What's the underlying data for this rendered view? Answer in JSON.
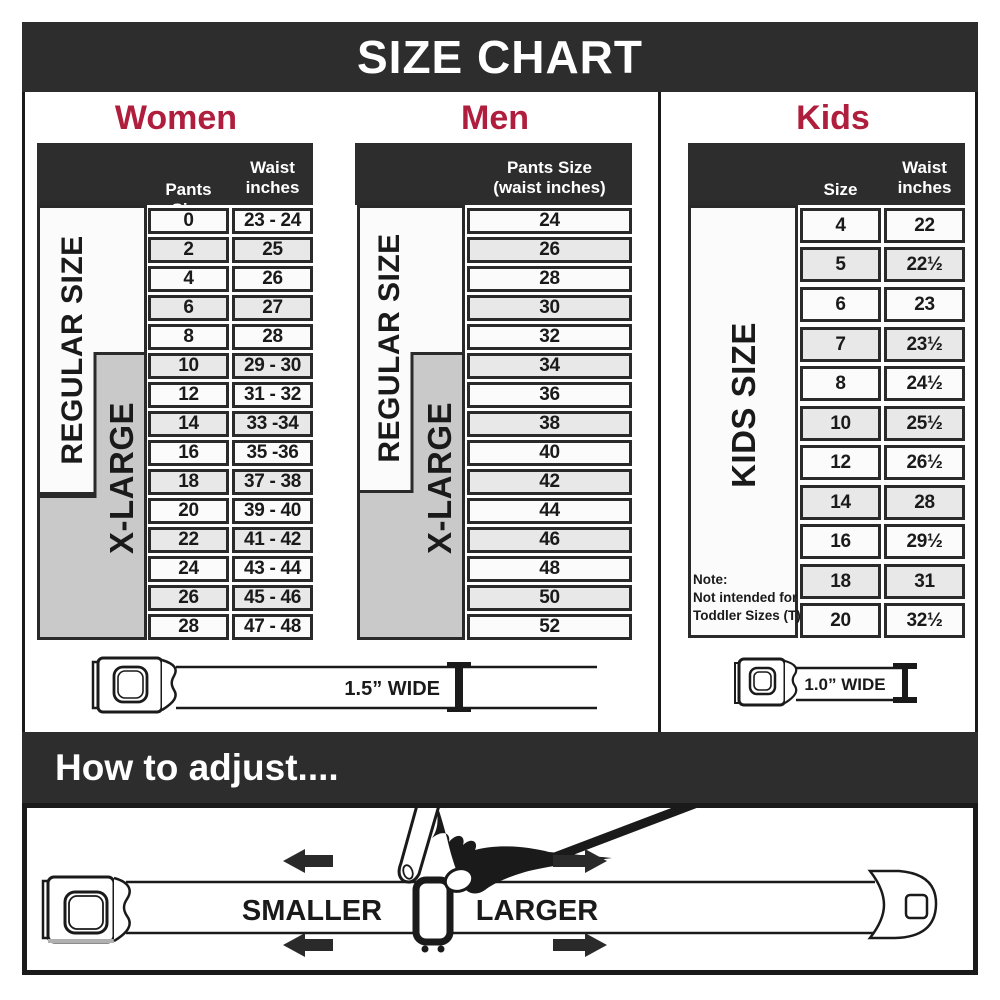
{
  "banner": {
    "title": "SIZE CHART"
  },
  "women": {
    "title": "Women",
    "col1_header": "Pants Size",
    "col2_header": "Waist\ninches",
    "regular_label": "REGULAR SIZE",
    "xlarge_label": "X-LARGE",
    "rows": [
      [
        "0",
        "23 - 24"
      ],
      [
        "2",
        "25"
      ],
      [
        "4",
        "26"
      ],
      [
        "6",
        "27"
      ],
      [
        "8",
        "28"
      ],
      [
        "10",
        "29 - 30"
      ],
      [
        "12",
        "31 - 32"
      ],
      [
        "14",
        "33 -34"
      ],
      [
        "16",
        "35 -36"
      ],
      [
        "18",
        "37 - 38"
      ],
      [
        "20",
        "39 - 40"
      ],
      [
        "22",
        "41 - 42"
      ],
      [
        "24",
        "43 - 44"
      ],
      [
        "26",
        "45 - 46"
      ],
      [
        "28",
        "47 - 48"
      ]
    ],
    "belt_width_label": "1.5” WIDE"
  },
  "men": {
    "title": "Men",
    "col_header": "Pants Size\n(waist inches)",
    "regular_label": "REGULAR SIZE",
    "xlarge_label": "X-LARGE",
    "rows": [
      "24",
      "26",
      "28",
      "30",
      "32",
      "34",
      "36",
      "38",
      "40",
      "42",
      "44",
      "46",
      "48",
      "50",
      "52"
    ]
  },
  "kids": {
    "title": "Kids",
    "col1_header": "Size",
    "col2_header": "Waist\ninches",
    "band_label": "KIDS SIZE",
    "note": "Note:\nNot intended for\nToddler Sizes (T)",
    "rows": [
      [
        "4",
        "22"
      ],
      [
        "5",
        "22½"
      ],
      [
        "6",
        "23"
      ],
      [
        "7",
        "23½"
      ],
      [
        "8",
        "24½"
      ],
      [
        "10",
        "25½"
      ],
      [
        "12",
        "26½"
      ],
      [
        "14",
        "28"
      ],
      [
        "16",
        "29½"
      ],
      [
        "18",
        "31"
      ],
      [
        "20",
        "32½"
      ]
    ],
    "belt_width_label": "1.0” WIDE"
  },
  "adjust": {
    "title": "How to adjust....",
    "smaller_label": "SMALLER",
    "larger_label": "LARGER"
  },
  "colors": {
    "accent": "#b01e3e",
    "dark": "#2d2d2d",
    "band_gray": "#c9c9c9",
    "row_alt": "#e8e8e8"
  }
}
